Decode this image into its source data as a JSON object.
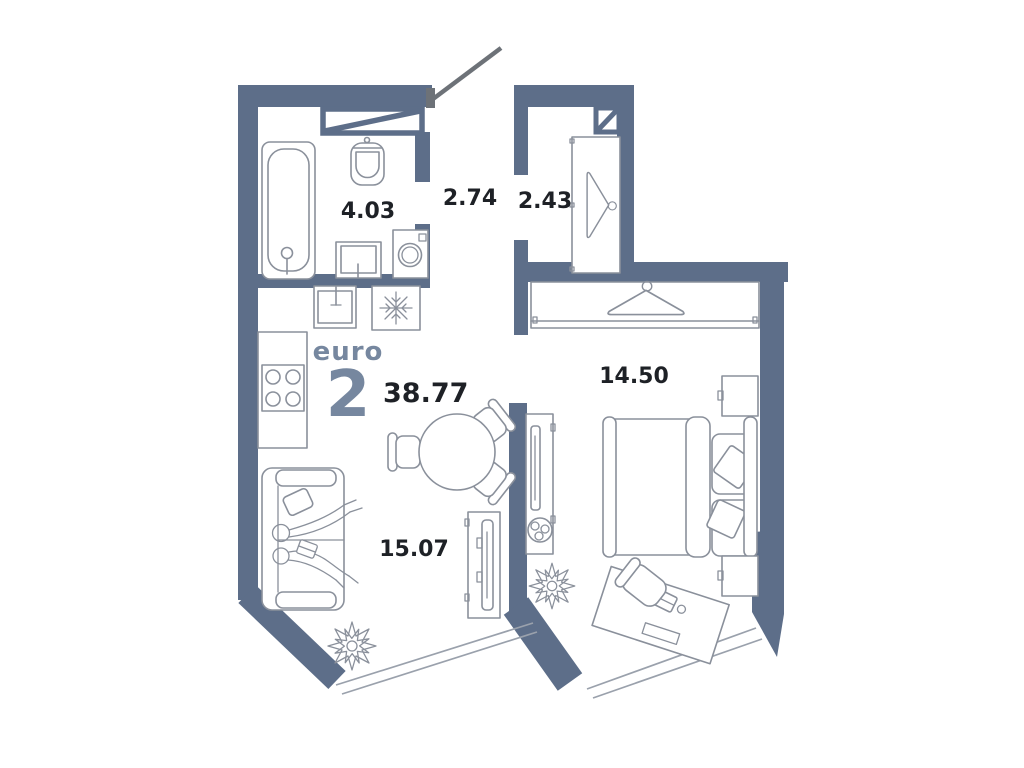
{
  "brand": {
    "label": "euro",
    "rooms_number": "2"
  },
  "total_area": "38.77",
  "rooms": [
    {
      "name": "bathroom",
      "area": "4.03"
    },
    {
      "name": "hallway",
      "area": "2.74"
    },
    {
      "name": "wardrobe",
      "area": "2.43"
    },
    {
      "name": "bedroom",
      "area": "14.50"
    },
    {
      "name": "living-kitchen",
      "area": "15.07"
    }
  ],
  "colors": {
    "wall": "#5d6e89",
    "brand": "#76879f",
    "label": "#1e2126",
    "furniture": "#8a909b",
    "window": "#9aa1ac",
    "door": "#6d7278",
    "background": "#ffffff"
  },
  "icons": {
    "bathtub-icon": "svg-outline",
    "toilet-icon": "svg-outline",
    "washbasin-icon": "svg-outline",
    "washing-machine-icon": "svg-outline",
    "kitchen-sink-icon": "svg-outline",
    "fridge-snowflake-icon": "svg-outline",
    "stove-icon": "svg-outline",
    "vent-shaft-icon": "svg-diagonal-box",
    "door-swing-icon": "svg-line",
    "hanger-icon": "svg-outline",
    "bed-icon": "svg-outline",
    "nightstand-icon": "svg-outline",
    "tv-stand-icon": "svg-outline",
    "tv-icon": "svg-outline",
    "plant-icon": "svg-star-burst",
    "desk-icon": "svg-outline",
    "chair-icon": "svg-outline",
    "sofa-icon": "svg-outline",
    "people-icon": "svg-outline",
    "dining-table-icon": "svg-circle",
    "window-icon": "svg-double-line"
  }
}
